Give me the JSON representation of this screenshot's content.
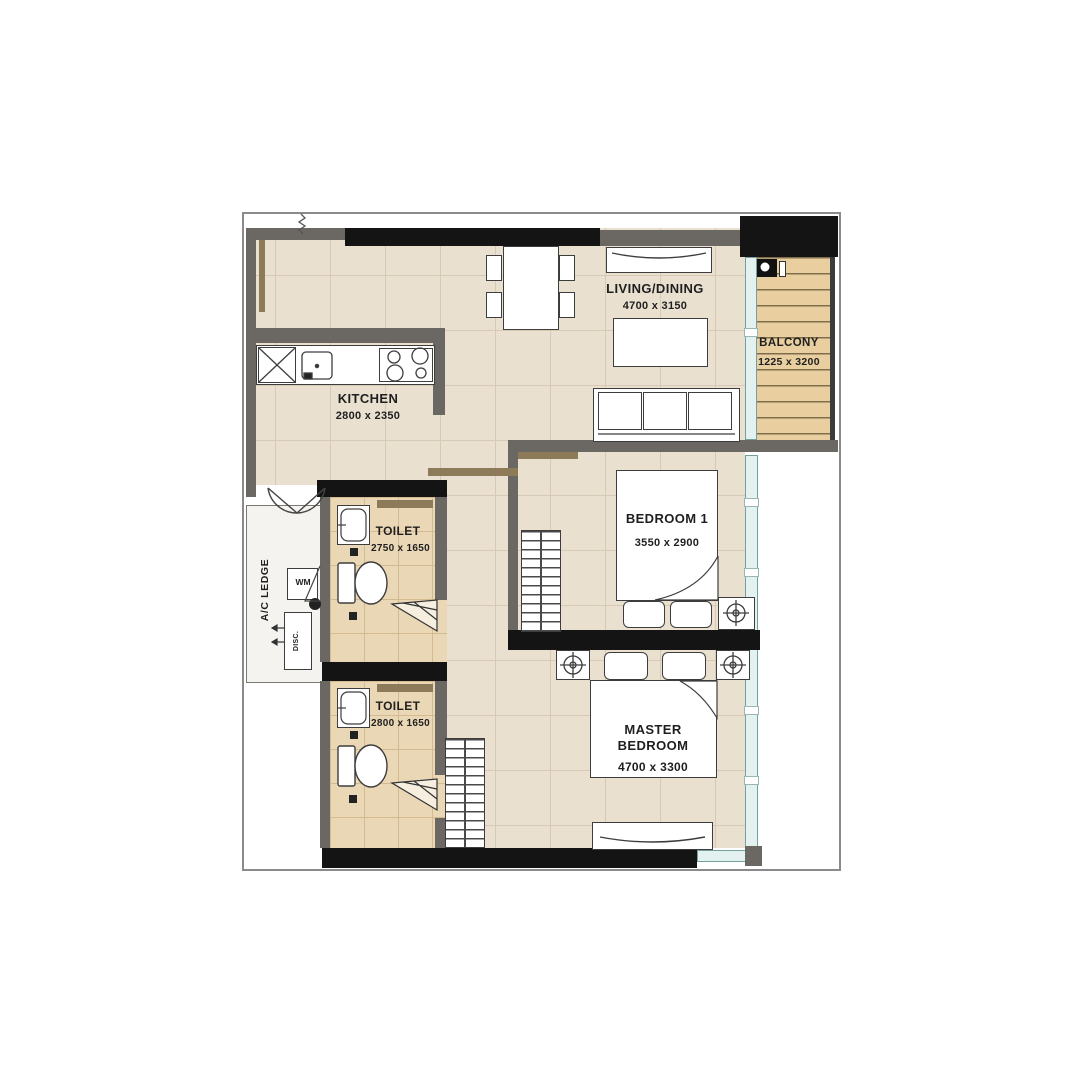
{
  "plan": {
    "title": "2-bedroom apartment floor plan",
    "rooms": {
      "living_dining": {
        "name": "LIVING/DINING",
        "dims": "4700 x 3150"
      },
      "kitchen": {
        "name": "KITCHEN",
        "dims": "2800 x 2350"
      },
      "balcony": {
        "name": "BALCONY",
        "dims": "1225 x 3200"
      },
      "bedroom1": {
        "name": "BEDROOM 1",
        "dims": "3550 x 2900"
      },
      "master_bedroom": {
        "name_line1": "MASTER",
        "name_line2": "BEDROOM",
        "dims": "4700 x 3300"
      },
      "toilet1": {
        "name": "TOILET",
        "dims": "2750 x 1650"
      },
      "toilet2": {
        "name": "TOILET",
        "dims": "2800 x 1650"
      },
      "ac_ledge": {
        "name": "A/C LEDGE"
      }
    },
    "labels": {
      "washing_machine": "WM",
      "ac_unit": "DISC."
    },
    "palette": {
      "tile_beige": "#eae0d0",
      "tile_tan": "#ead7b6",
      "wood_deck": "#e9cfa0",
      "wall_gray": "#6b6763",
      "wall_black": "#141414",
      "glazing": "#e3f2f1",
      "accent_brown": "#8c7a58",
      "text": "#1f1f1f"
    }
  }
}
